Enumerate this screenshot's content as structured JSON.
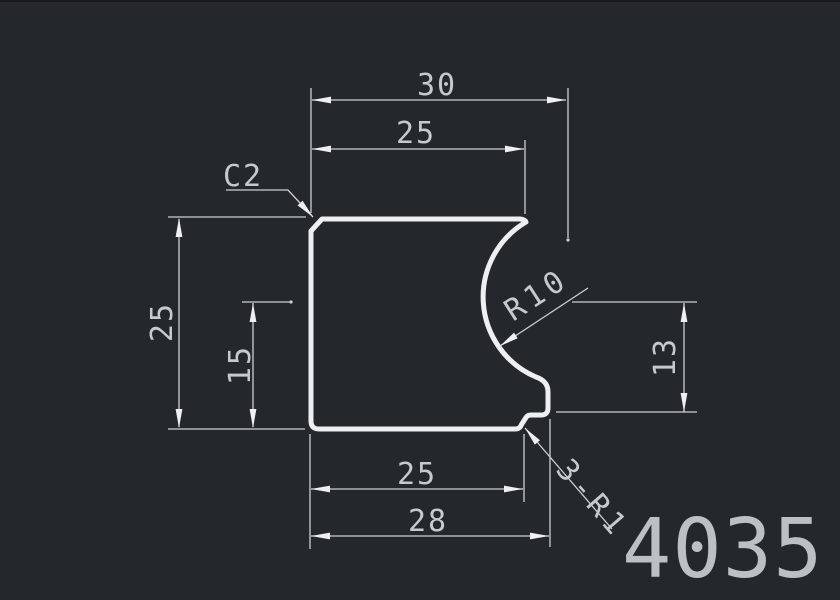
{
  "drawing": {
    "part_number": "4035",
    "colors": {
      "background": "#24272c",
      "outline": "#edeff2",
      "dimension": "#ccd0d5",
      "text": "#c6cacf",
      "part_number_text": "#bcc0c5"
    },
    "dims": {
      "top_overall": "30",
      "top_face": "25",
      "left_overall": "25",
      "left_groove": "15",
      "right_groove": "13",
      "bottom_face": "25",
      "bottom_overall": "28"
    },
    "callouts": {
      "chamfer": "C2",
      "groove_radius": "R10",
      "corner_fillets": "3-R1"
    }
  }
}
